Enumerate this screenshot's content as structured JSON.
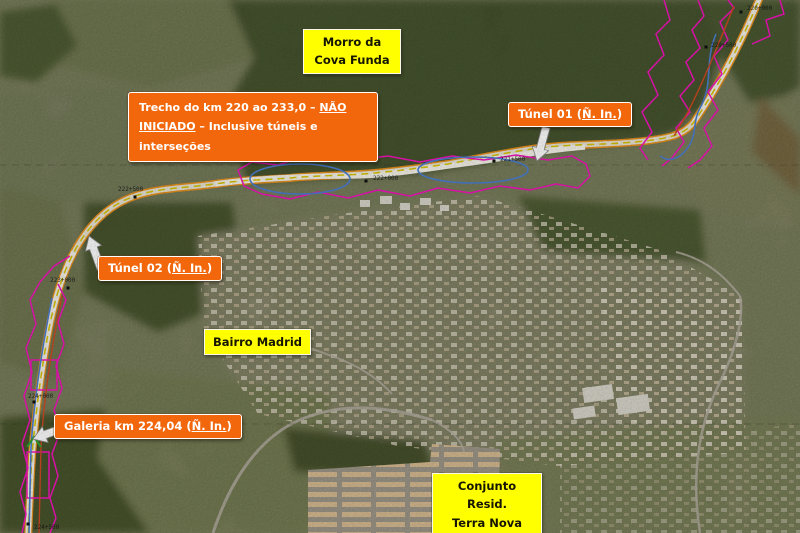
{
  "colors": {
    "label-yellow": "#ffff00",
    "label-orange": "#f2670c",
    "label-text-dark": "#151500",
    "label-text-light": "#ffffff",
    "route-edge-orange": "#e8901c",
    "route-dash-yellow": "#d8c400",
    "boundary-magenta": "#f513bd",
    "tunnel-blue": "#4d7fd0",
    "aux-red": "#cf4a22"
  },
  "labels": {
    "morro": {
      "line1": "Morro da",
      "line2": "Cova Funda"
    },
    "bairro_madrid": {
      "line1": "Bairro Madrid"
    },
    "terra_nova": {
      "line1": "Conjunto Resid.",
      "line2": "Terra Nova (1)"
    }
  },
  "callouts": {
    "trecho": {
      "part1": "Trecho do km 220 ao 233,0 – ",
      "part2": "NÃO INICIADO",
      "part3": " – Inclusive túneis e interseções"
    },
    "tunel01": {
      "prefix": "Túnel 01 (",
      "em": "Ñ. In.",
      "suffix": ")"
    },
    "tunel02": {
      "prefix": "Túnel 02 (",
      "em": "Ñ. In.",
      "suffix": ")"
    },
    "galeria": {
      "prefix": "Galeria km 224,04 (",
      "em": "Ñ. In.",
      "suffix": ")"
    }
  },
  "stations": [
    {
      "label": "220+000",
      "x": 741,
      "y": 12,
      "dx": 6,
      "dy": -4
    },
    {
      "label": "220+500",
      "x": 706,
      "y": 47,
      "dx": 5,
      "dy": -2
    },
    {
      "label": "221+500",
      "x": 494,
      "y": 161,
      "dx": 6,
      "dy": -2
    },
    {
      "label": "222+000",
      "x": 366,
      "y": 181,
      "dx": 7,
      "dy": -3
    },
    {
      "label": "222+500",
      "x": 135,
      "y": 197,
      "dx": -17,
      "dy": -8
    },
    {
      "label": "223+000",
      "x": 68,
      "y": 288,
      "dx": -18,
      "dy": -8
    },
    {
      "label": "224+000",
      "x": 34,
      "y": 402,
      "dx": -6,
      "dy": -6
    },
    {
      "label": "224+500",
      "x": 28,
      "y": 524,
      "dx": 6,
      "dy": 3
    }
  ]
}
